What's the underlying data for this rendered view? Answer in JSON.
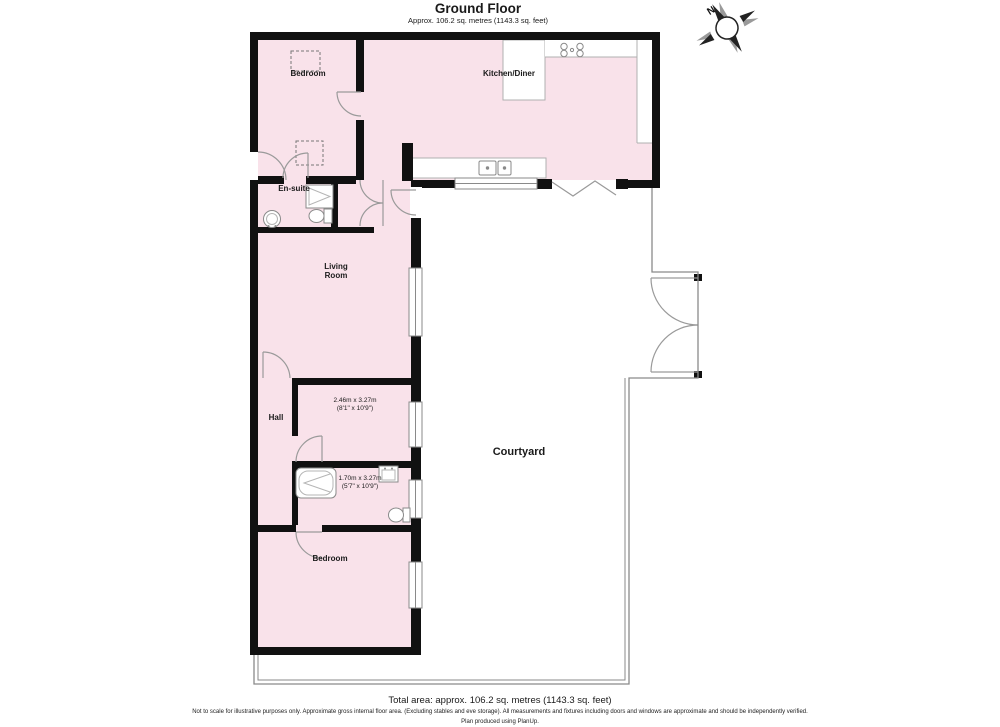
{
  "header": {
    "title": "Ground Floor",
    "subtitle": "Approx. 106.2 sq. metres (1143.3 sq. feet)"
  },
  "compass": {
    "north_label": "N"
  },
  "rooms": {
    "bedroom_top": {
      "label": "Bedroom"
    },
    "kitchen": {
      "label": "Kitchen/Diner"
    },
    "ensuite": {
      "label": "En-suite"
    },
    "living_room": {
      "label": "Living Room"
    },
    "hall": {
      "label": "Hall"
    },
    "inner_room": {
      "dims_metric": "2.46m x 3.27m",
      "dims_imperial": "(8'1\" x 10'9\")"
    },
    "bathroom": {
      "dims_metric": "1.70m x 3.27m",
      "dims_imperial": "(5'7\" x 10'9\")"
    },
    "bedroom_bottom": {
      "label": "Bedroom"
    },
    "courtyard": {
      "label": "Courtyard"
    }
  },
  "footer": {
    "total_area": "Total area: approx. 106.2 sq. metres (1143.3 sq. feet)",
    "disclaimer": "Not to scale for illustrative purposes only. Approximate gross internal floor area. (Excluding stables and eve storage). All measurements and fixtures including doors and windows are approximate and should be independently verified.",
    "credit": "Plan produced using PlanUp."
  },
  "icons": {
    "compass": "compass-rose-icon",
    "fixtures": [
      "hob-icon",
      "kitchen-sink-icon",
      "shower-icon",
      "toilet-icon",
      "washbasin-icon",
      "bathtub-icon"
    ]
  },
  "colors": {
    "room_fill": "#f9e2ea",
    "wall": "#111111",
    "thin_line": "#999999"
  }
}
